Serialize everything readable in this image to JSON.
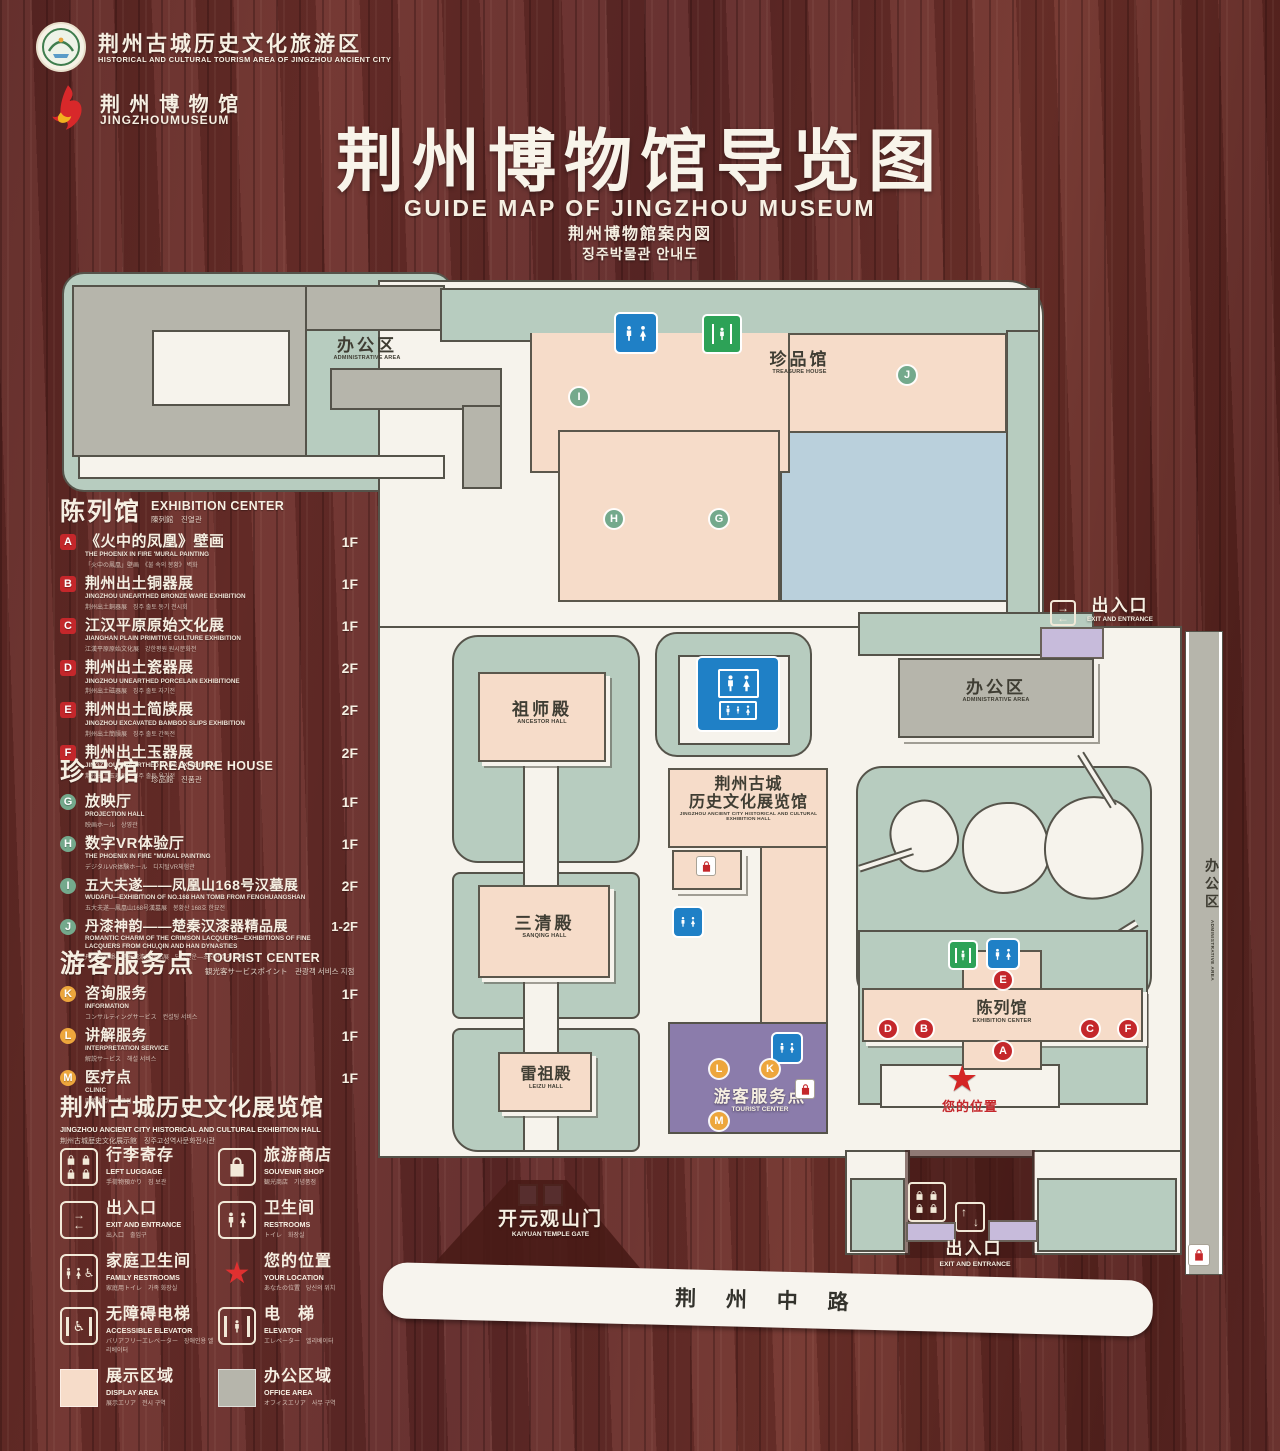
{
  "header": {
    "org1_cn": "荆州古城历史文化旅游区",
    "org1_en": "HISTORICAL AND CULTURAL TOURISM AREA OF JINGZHOU ANCIENT CITY",
    "org2_cn": "荆 州 博 物 馆",
    "org2_en": "JINGZHOUMUSEUM",
    "title_cn": "荆州博物馆导览图",
    "title_en": "GUIDE MAP OF JINGZHOU MUSEUM",
    "title_ja": "荆州博物館案内図",
    "title_ko": "징주박물관 안내도"
  },
  "legend": {
    "exhibition": {
      "cn": "陈列馆",
      "en": "EXHIBITION CENTER",
      "sub": "陳列館　진열관",
      "items": [
        {
          "letter": "A",
          "cn": "《火中的凤凰》壁画",
          "en": "THE PHOENIX IN FIRE 'MURAL PAINTING",
          "sub": "「火中の鳳凰」壁画　《불 속의 봉황》 벽화",
          "floor": "1F"
        },
        {
          "letter": "B",
          "cn": "荆州出土铜器展",
          "en": "JINGZHOU UNEARTHED BRONZE WARE EXHIBITION",
          "sub": "荆州出土銅器展　징주 출토 동기 전시회",
          "floor": "1F"
        },
        {
          "letter": "C",
          "cn": "江汉平原原始文化展",
          "en": "JIANGHAN PLAIN PRIMITIVE CULTURE EXHIBITION",
          "sub": "江漢平原原始文化展　강한평원 원시문화전",
          "floor": "1F"
        },
        {
          "letter": "D",
          "cn": "荆州出土瓷器展",
          "en": "JINGZHOU UNEARTHED PORCELAIN EXHIBITIONE",
          "sub": "荆州出土磁器展　징주 출토 자기전",
          "floor": "2F"
        },
        {
          "letter": "E",
          "cn": "荆州出土简牍展",
          "en": "JINGZHOU EXCAVATED BAMBOO SLIPS EXHIBITION",
          "sub": "荆州出土簡牘展　징주 출토 간독전",
          "floor": "2F"
        },
        {
          "letter": "F",
          "cn": "荆州出土玉器展",
          "en": "JINGZHOU UNEARTHED JADE EXHIBITION",
          "sub": "荆州出土玉器展　징주 출토 옥기전",
          "floor": "2F"
        }
      ]
    },
    "treasure": {
      "cn": "珍品馆",
      "en": "TREASURE HOUSE",
      "sub": "珍品館　진품관",
      "items": [
        {
          "letter": "G",
          "cn": "放映厅",
          "en": "PROJECTION HALL",
          "sub": "映画ホール　상영관",
          "floor": "1F"
        },
        {
          "letter": "H",
          "cn": "数字VR体验厅",
          "en": "THE PHOENIX IN FIRE \"MURAL PAINTING",
          "sub": "デジタルVR体験ホール　디지털VR체험관",
          "floor": "1F"
        },
        {
          "letter": "I",
          "cn": "五大夫遂——凤凰山168号汉墓展",
          "en": "WUDAFU—EXHIBITION OF NO.168 HAN TOMB FROM FENGHUANGSHAN",
          "sub": "五大夫遂—鳳凰山168号漢墓展　봉황산 168호 한묘전",
          "floor": "2F"
        },
        {
          "letter": "J",
          "cn": "丹漆神韵——楚秦汉漆器精品展",
          "en": "ROMANTIC CHARM OF THE CRIMSON LACQUERS—EXHIBITIONS OF FINE LACQUERS FROM CHU,QIN AND HAN DYNASTIES",
          "sub": "丹漆の神韻—楚秦漢漆器精品展　단칠신운—초진한 칠기 정품전",
          "floor": "1-2F"
        }
      ]
    },
    "tourist": {
      "cn": "游客服务点",
      "en": "TOURIST CENTER",
      "sub": "観光客サービスポイント　관광객 서비스 지점",
      "items": [
        {
          "letter": "K",
          "cn": "咨询服务",
          "en": "INFORMATION",
          "sub": "コンサルティングサービス　컨설팅 서비스",
          "floor": "1F"
        },
        {
          "letter": "L",
          "cn": "讲解服务",
          "en": "INTERPRETATION SERVICE",
          "sub": "解説サービス　해설 서비스",
          "floor": "1F"
        },
        {
          "letter": "M",
          "cn": "医疗点",
          "en": "CLINIC",
          "sub": "医療拠点　의료점",
          "floor": "1F"
        }
      ]
    },
    "hall": {
      "cn": "荆州古城历史文化展览馆",
      "en": "JINGZHOU ANCIENT CITY HISTORICAL AND CULTURAL EXHIBITION HALL",
      "sub": "荆州古城歴史文化展示館　징주고성역사문화전시관"
    }
  },
  "icon_legend": {
    "items": [
      {
        "icon": "left-luggage-icon",
        "cn": "行李寄存",
        "en": "LEFT LUGGAGE",
        "sub": "手荷物預かり　짐 보관"
      },
      {
        "icon": "souvenir-shop-icon",
        "cn": "旅游商店",
        "en": "SOUVENIR SHOP",
        "sub": "観光商店　기념품점"
      },
      {
        "icon": "exit-entrance-icon",
        "cn": "出入口",
        "en": "EXIT AND ENTRANCE",
        "sub": "出入口　출입구"
      },
      {
        "icon": "restrooms-icon",
        "cn": "卫生间",
        "en": "RESTROOMS",
        "sub": "トイレ　화장실"
      },
      {
        "icon": "family-restrooms-icon",
        "cn": "家庭卫生间",
        "en": "FAMILY RESTROOMS",
        "sub": "家庭用トイレ　가족 화장실"
      },
      {
        "icon": "your-location-icon",
        "cn": "您的位置",
        "en": "YOUR LOCATION",
        "sub": "あなたの位置　당신의 위치"
      },
      {
        "icon": "accessible-elevator-icon",
        "cn": "无障碍电梯",
        "en": "ACCESSIBLE ELEVATOR",
        "sub": "バリアフリーエレベーター　장애인용 엘리베이터"
      },
      {
        "icon": "elevator-icon",
        "cn": "电　梯",
        "en": "ELEVATOR",
        "sub": "エレベーター　엘리베이터"
      },
      {
        "icon": "display-area-swatch",
        "cn": "展示区域",
        "en": "DISPLAY AREA",
        "sub": "展示エリア　전시 구역"
      },
      {
        "icon": "office-area-swatch",
        "cn": "办公区域",
        "en": "OFFICE AREA",
        "sub": "オフィスエリア　사무 구역"
      }
    ]
  },
  "map": {
    "nw_admin_cn": "办公区",
    "nw_admin_en": "ADMINISTRATIVE AREA",
    "treasure_cn": "珍品馆",
    "treasure_en": "TREASURE HOUSE",
    "ancestor_cn": "祖师殿",
    "ancestor_en": "ANCESTOR HALL",
    "sanqing_cn": "三清殿",
    "sanqing_en": "SANQING HALL",
    "leizu_cn": "雷祖殿",
    "leizu_en": "LEIZU HALL",
    "exh_hall_cn1": "荆州古城",
    "exh_hall_cn2": "历史文化展览馆",
    "exh_hall_en": "JINGZHOU ANCIENT CITY HISTORICAL AND CULTURAL EXHIBITION HALL",
    "tourist_cn": "游客服务点",
    "tourist_en": "TOURIST CENTER",
    "exh_center_cn": "陈列馆",
    "exh_center_en": "EXHIBITION CENTER",
    "e_admin_cn": "办公区",
    "e_admin_en": "ADMINISTRATIVE AREA",
    "strip_admin_cn": "办公区",
    "strip_admin_en": "ADMINISTRATIVE AREA",
    "exit_ne_cn": "出入口",
    "exit_ne_en": "EXIT AND ENTRANCE",
    "exit_s_cn": "出入口",
    "exit_s_en": "EXIT AND ENTRANCE",
    "gate_cn": "开元观山门",
    "gate_en": "KAIYUAN TEMPLE GATE",
    "road": "荆 州 中 路",
    "your_location": "您的位置",
    "markers": [
      {
        "letter": "I"
      },
      {
        "letter": "J"
      },
      {
        "letter": "H"
      },
      {
        "letter": "G"
      },
      {
        "letter": "E"
      },
      {
        "letter": "D"
      },
      {
        "letter": "B"
      },
      {
        "letter": "C"
      },
      {
        "letter": "F"
      },
      {
        "letter": "A"
      },
      {
        "letter": "L"
      },
      {
        "letter": "K"
      },
      {
        "letter": "M"
      }
    ]
  },
  "colors": {
    "accent_red": "#c4272b",
    "marker_green": "#74a98c",
    "marker_orange": "#eda63c",
    "restroom_blue": "#1f80c6",
    "elevator_green": "#2da257",
    "display_area": "#f6dcc9",
    "office_area": "#b6b5ab",
    "ground_green": "#b7ccbf",
    "lake_blue": "#bad0dc",
    "tourist_purple": "#8b7cab"
  }
}
